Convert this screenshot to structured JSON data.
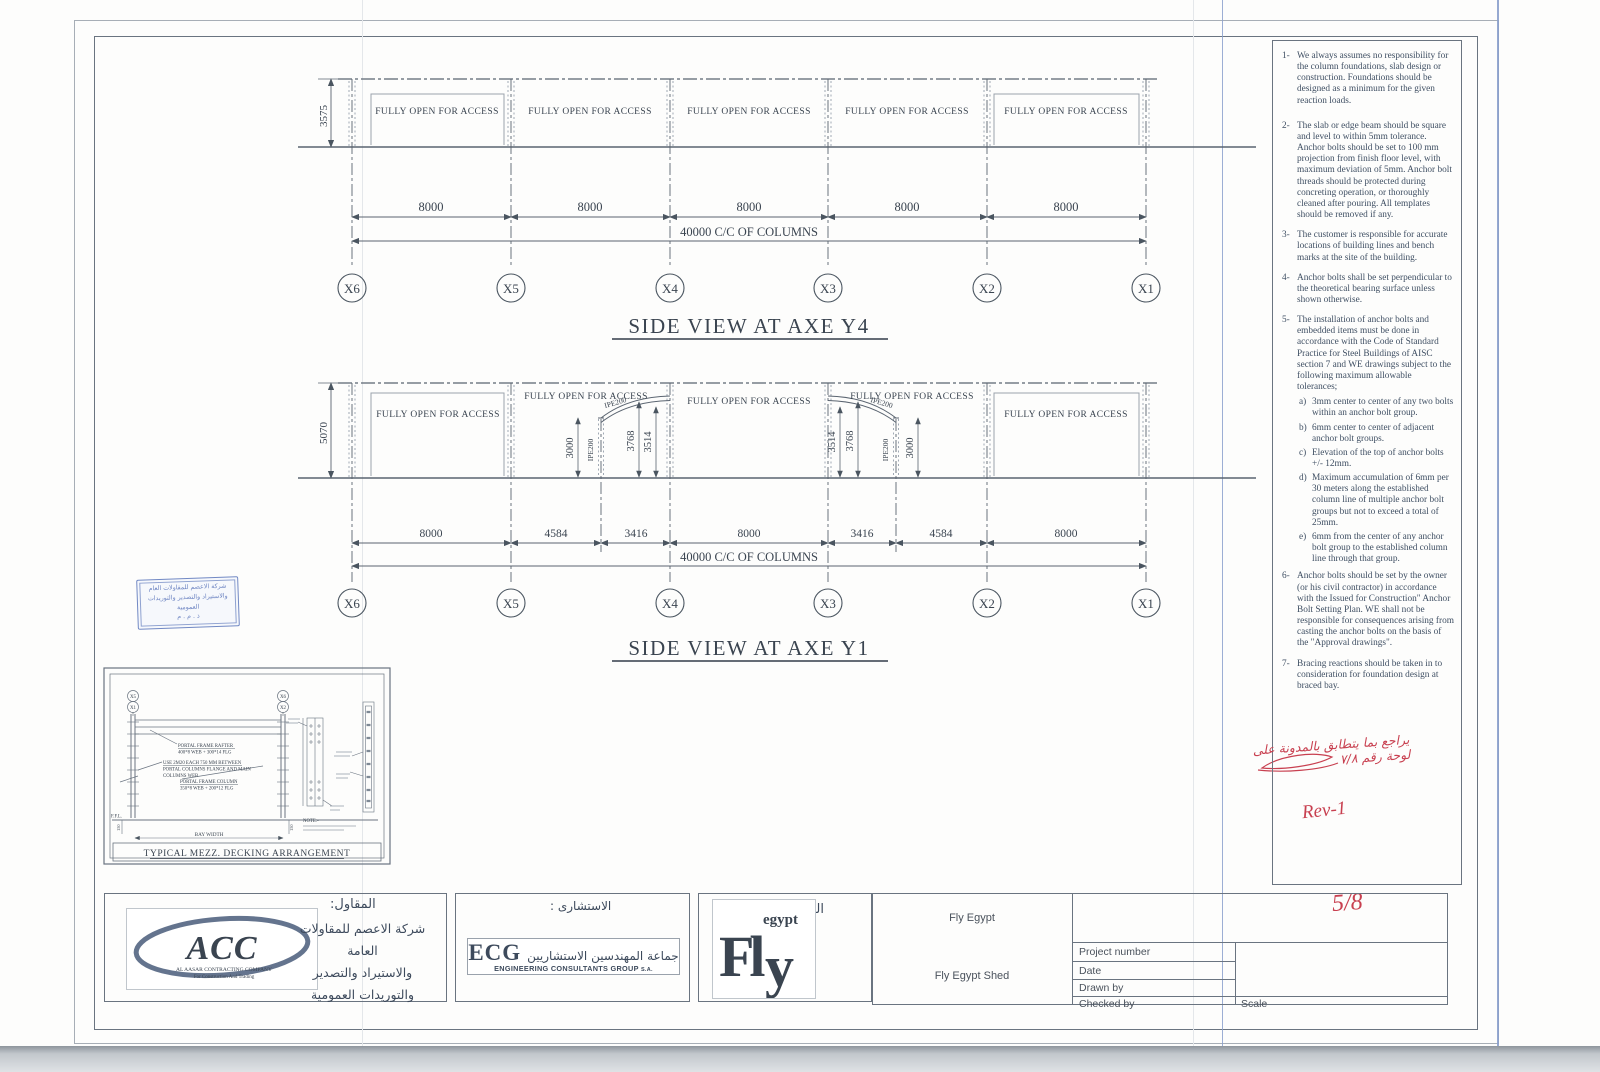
{
  "views": {
    "columns": [
      "X6",
      "X5",
      "X4",
      "X3",
      "X2",
      "X1"
    ],
    "open_label": "FULLY OPEN FOR ACCESS",
    "total_label": "40000 C/C OF COLUMNS",
    "y4": {
      "title": "SIDE VIEW AT AXE Y4",
      "height": "3575",
      "bay": "8000"
    },
    "y1": {
      "title": "SIDE VIEW AT AXE Y1",
      "height": "5070",
      "d8000": "8000",
      "d4584": "4584",
      "d3416": "3416",
      "h3000": "3000",
      "h3768": "3768",
      "h3514": "3514",
      "ipe": "IPE200"
    }
  },
  "detail": {
    "title": "TYPICAL MEZZ. DECKING ARRANGEMENT",
    "grid_tl": "X5",
    "grid_tl2": "X1",
    "grid_tr": "X6",
    "grid_tr2": "X2",
    "rafter1": "PORTAL FRAME RAFTER",
    "rafter2": "400*8 WEB + 300*14 FLG",
    "bolt1": "USE 2M20 EACH 750 MM BETWEEN",
    "bolt2": "PORTAL COLUMNS FLANGE AND MAIN",
    "bolt3": "COLUMNS WEB",
    "col1": "PORTAL FRAME COLUMN",
    "col2": "350*8 WEB + 200*12 FLG",
    "ffl": "F.F.L.",
    "bay_width": "BAY WIDTH",
    "d150": "150",
    "note": "NOTE:-"
  },
  "notes": {
    "items": [
      {
        "num": "1-",
        "text": "We always assumes no responsibility for the column foundations, slab design or construction.  Foundations should be designed as a minimum for the given reaction loads."
      },
      {
        "num": "2-",
        "text": "The slab or edge beam should be square and level to within 5mm tolerance. Anchor bolts should be set to 100 mm projection from finish floor level, with maximum deviation of 5mm. Anchor bolt threads should be protected during concreting operation, or thoroughly cleaned after pouring. All templates should be removed if any."
      },
      {
        "num": "3-",
        "text": "The customer is responsible for accurate locations of building lines and bench marks at the site of the building."
      },
      {
        "num": "4-",
        "text": "Anchor bolts shall be set perpendicular to the theoretical bearing surface unless shown otherwise."
      },
      {
        "num": "5-",
        "text": "The installation of anchor bolts and embedded items must be done in accordance with the Code of Standard Practice for Steel Buildings of AISC section 7 and WE drawings subject to the following maximum allowable tolerances;"
      },
      {
        "num": "6-",
        "text": "Anchor bolts should be set by the owner (or his civil contractor) in accordance with the Issued for Construction\" Anchor Bolt Setting Plan. WE shall not be responsible for consequences arising from casting the anchor bolts on the basis of the \"Approval drawings\"."
      },
      {
        "num": "7-",
        "text": "Bracing reactions should be taken in to consideration for foundation design at braced bay."
      }
    ],
    "sub5": [
      {
        "num": "a)",
        "text": "3mm center to center of any two bolts within an anchor bolt group."
      },
      {
        "num": "b)",
        "text": "6mm center to center of adjacent anchor bolt groups."
      },
      {
        "num": "c)",
        "text": "Elevation of the top of anchor bolts +/- 12mm."
      },
      {
        "num": "d)",
        "text": "Maximum accumulation of 6mm per 30 meters along the established column line of multiple anchor bolt groups but not to exceed a total of 25mm."
      },
      {
        "num": "e)",
        "text": "6mm from the center of any anchor bolt group to the established column line through that group."
      }
    ]
  },
  "titleblock": {
    "contractor_label": "المقاول:",
    "contractor_line1": "شركة الاعصم للمقاولات العامة",
    "contractor_line2": "والاستيراد والتصدير",
    "contractor_line3": "والتوريدات العمومية",
    "acc": {
      "name": "ACC",
      "sub1": "AL AASAR CONTRACTING COMPANY",
      "sub2": "For Construction And Trading"
    },
    "consultant_label": "الاستشارى :",
    "ecg": {
      "name": "ECG",
      "arabic": "جماعة المهندسين الاستشاريين",
      "caption": "ENGINEERING CONSULTANTS GROUP",
      "sa": "S.A."
    },
    "owner_label": "المالك",
    "fly": {
      "f": "Fl",
      "y": "y",
      "egypt": "egypt"
    },
    "project_owner": "Fly Egypt",
    "project_name": "Fly Egypt Shed",
    "field_project": "Project number",
    "field_date": "Date",
    "field_drawn": "Drawn by",
    "field_checked": "Checked by",
    "field_scale": "Scale"
  },
  "annotations": {
    "fraction": "5/8",
    "rev": "Rev-1",
    "arabic_note": "يراجع بما يتطابق بالمدونة على لوحة رقم ٧/٨"
  },
  "stamp": {
    "line1": "شركة الاعصم للمقاولات العام",
    "line2": "والاستيراد والتصدير والتوريدات العمومية",
    "line3": "ذ . م . م"
  }
}
